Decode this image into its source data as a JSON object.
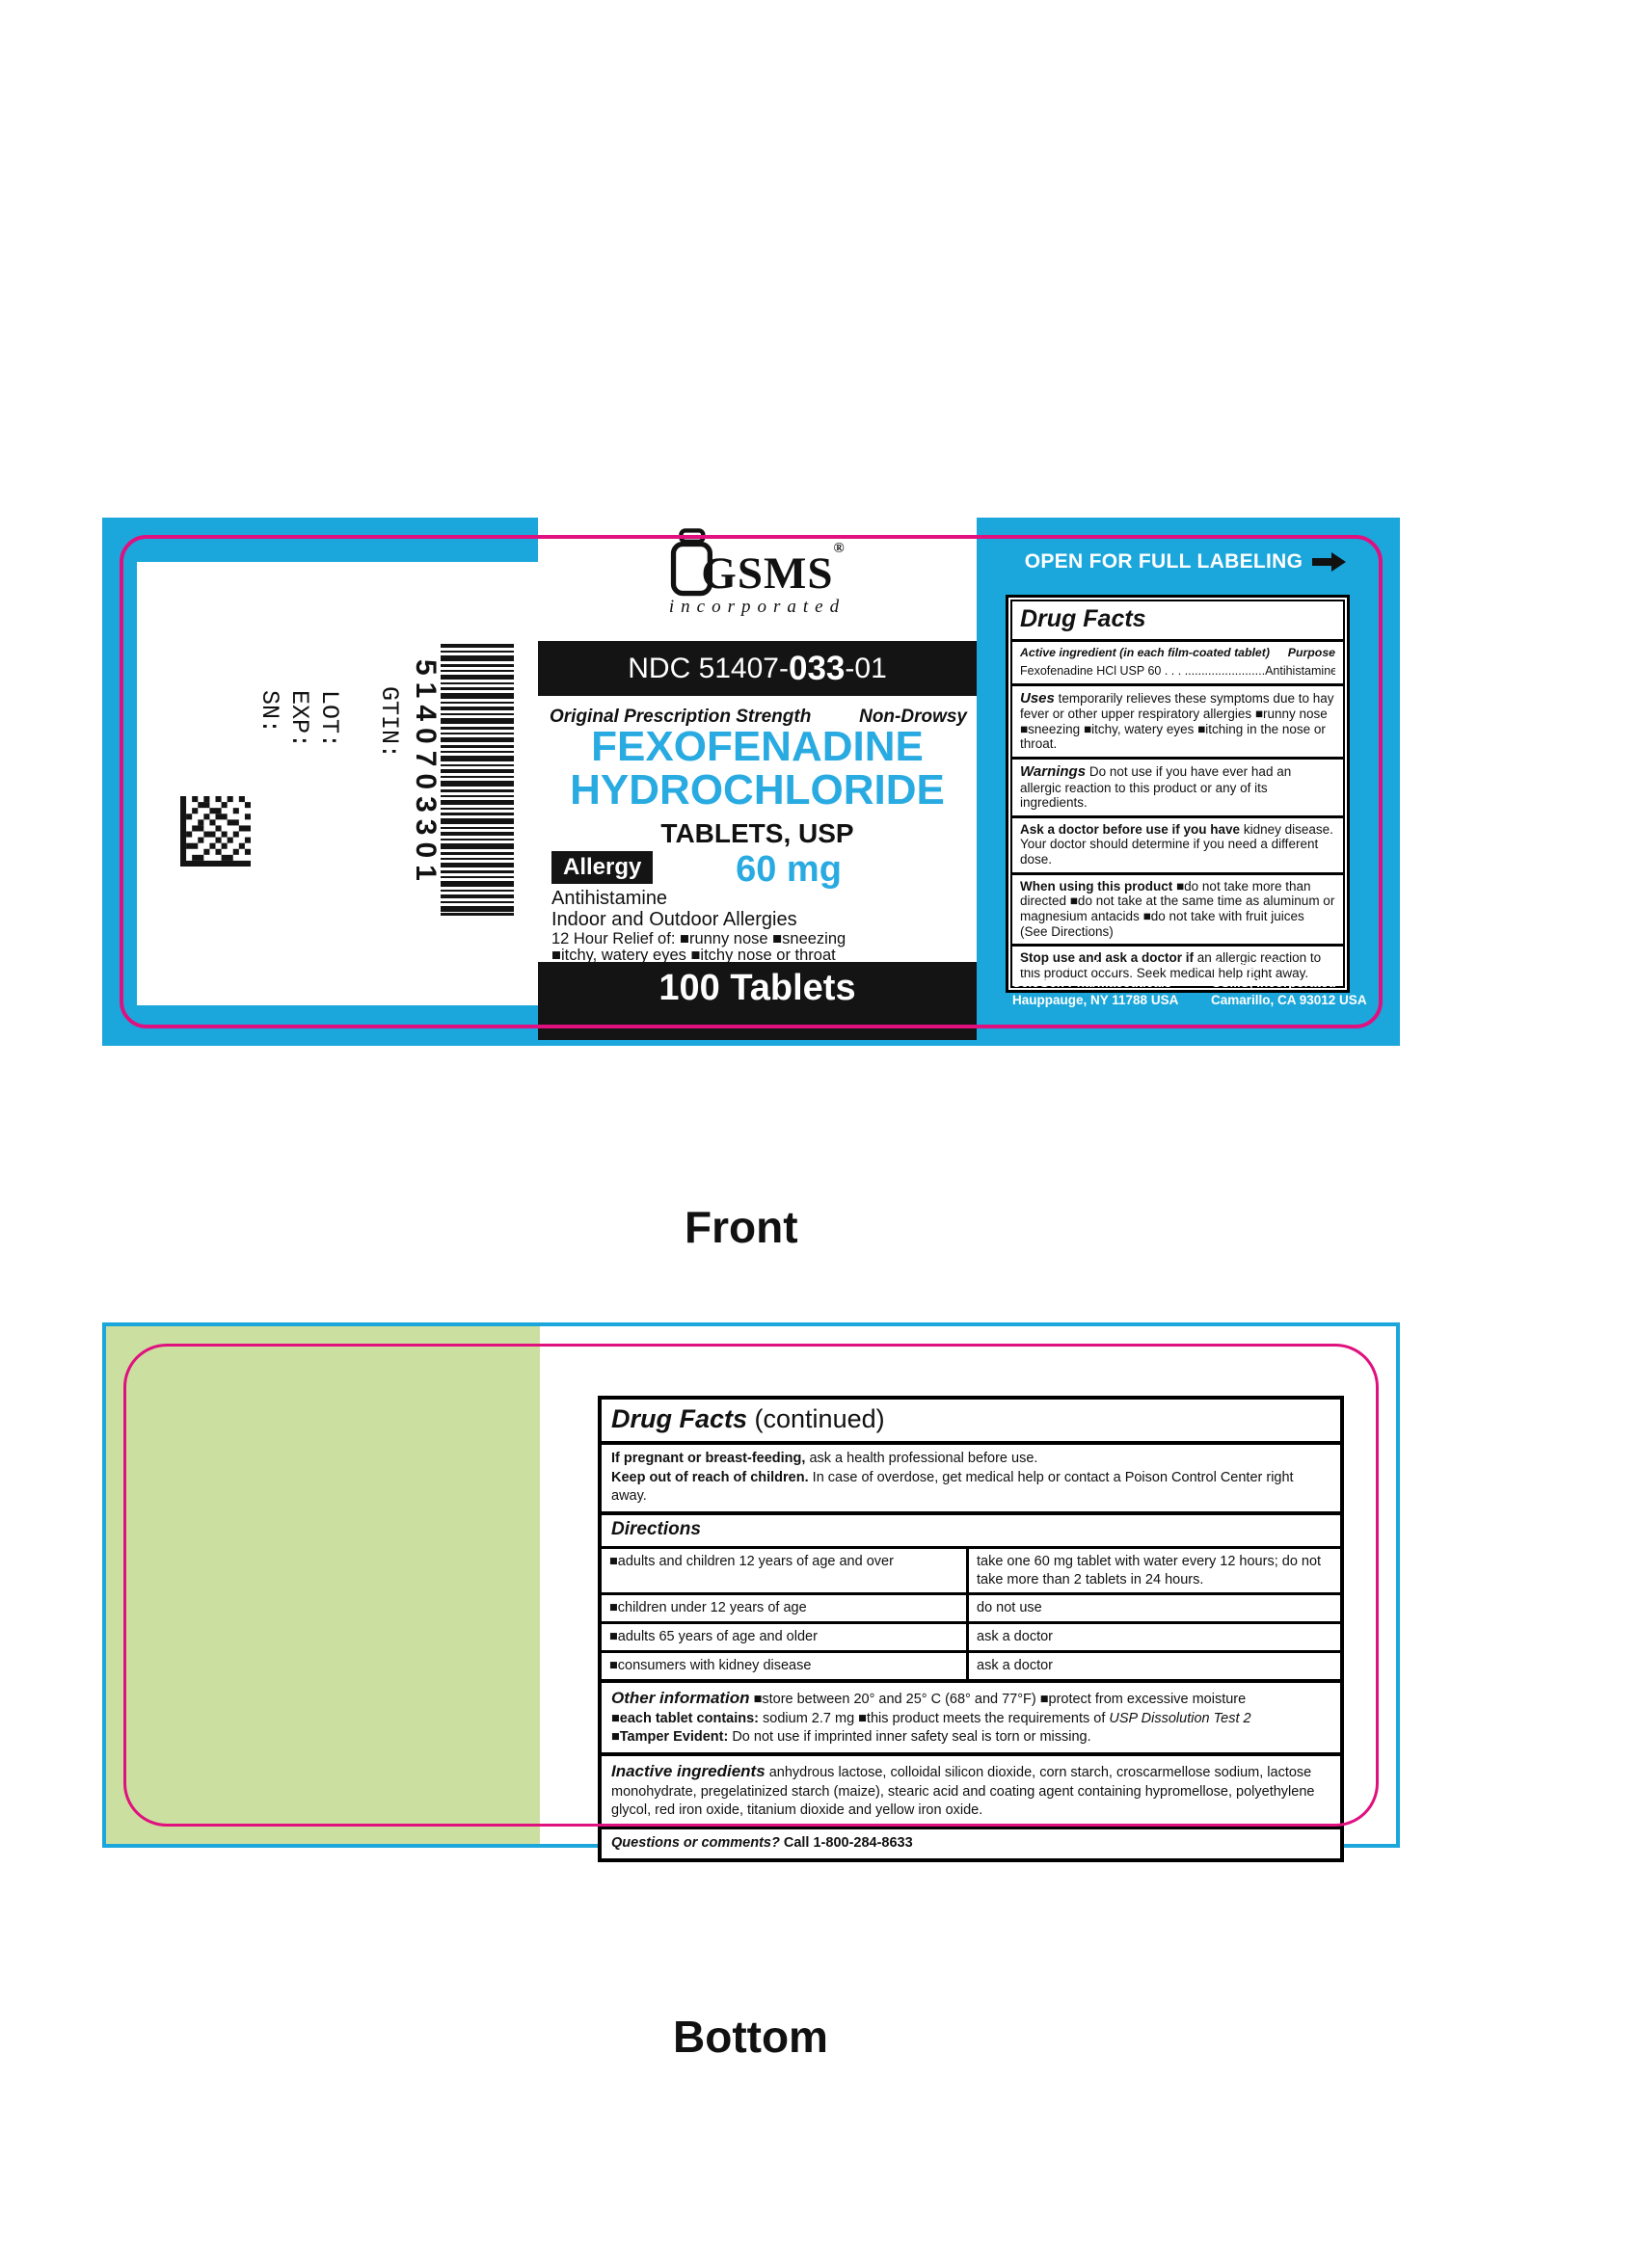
{
  "captions": {
    "front": "Front",
    "bottom": "Bottom"
  },
  "colors": {
    "cyan": "#1BA7DC",
    "magenta": "#E0107F",
    "drug_name_cyan": "#29ABE2",
    "green": "#CBDFA0",
    "bar_black": "#141414"
  },
  "front": {
    "open_label": "OPEN FOR FULL LABELING",
    "logo": {
      "gsms": "GSMS",
      "reg": "®",
      "inc": "incorporated"
    },
    "ndc": {
      "p1": "NDC 51407-",
      "p2": "033",
      "p3": "-01"
    },
    "strength_left": "Original Prescription Strength",
    "strength_right": "Non-Drowsy",
    "name1": "FEXOFENADINE",
    "name2": "HYDROCHLORIDE",
    "form": "TABLETS, USP",
    "allergy": "Allergy",
    "dose": "60 mg",
    "antihistamine": "Antihistamine",
    "indoor": "Indoor and Outdoor Allergies",
    "relief1": "12 Hour Relief of: ■runny nose ■sneezing",
    "relief2": "■itchy, watery eyes ■itchy nose or throat",
    "count": "100 Tablets",
    "serials": {
      "gtin": "GTIN:",
      "lot": "LOT:",
      "exp": "EXP:",
      "sn": "SN:",
      "code": "5140703301"
    },
    "facts": {
      "title": "Drug Facts",
      "active_header": "Active ingredient (in each film-coated tablet)",
      "purpose_header": "Purpose",
      "active_name": "Fexofenadine HCl USP 60",
      "active_dots": " . . . ........................",
      "active_purpose": "Antihistamine",
      "uses_lead": "Uses",
      "uses_text": " temporarily relieves these symptoms due to hay fever or other upper respiratory allergies ■runny nose ■sneezing ■itchy, watery eyes ■itching in the nose or throat.",
      "warn_lead": "Warnings",
      "warn_text": " Do not use if you have ever had an allergic reaction to this product or any of its ingredients.",
      "ask_lead": "Ask a doctor before use if you have",
      "ask_text": " kidney disease. Your doctor should determine if you need a different dose.",
      "when_lead": "When using this product",
      "when_text": " ■do not take more than directed ■do not take at the same time as aluminum or magnesium antacids ■do not take with fruit juices (See Directions)",
      "stop_lead": "Stop use and ask a doctor if",
      "stop_text": " an allergic reaction to this product occurs. Seek medical help right away."
    },
    "mfg": {
      "label": "Manufactured by:",
      "line1": "ScieGen Pharmaceuticals",
      "line2": "Hauppauge, NY 11788 USA"
    },
    "pkg": {
      "label": "Packaged by:",
      "line1": "GSMS, Incorporated",
      "line2": "Camarillo, CA 93012 USA"
    }
  },
  "bottom": {
    "facts": {
      "title": "Drug Facts",
      "continued": " (continued)",
      "preg_lead": "If pregnant or breast-feeding,",
      "preg_text": " ask a health professional before use.",
      "keep_lead": "Keep out of reach of children.",
      "keep_text": " In case of overdose, get medical help or contact a Poison Control Center right away.",
      "directions_title": "Directions",
      "rows": [
        {
          "who": "■adults and children 12 years of age and over",
          "dose": "take one 60 mg tablet with water every 12 hours; do not take more than 2 tablets in 24 hours."
        },
        {
          "who": "■children under 12 years of age",
          "dose": "do not use"
        },
        {
          "who": "■adults 65 years of age and older",
          "dose": "ask a doctor"
        },
        {
          "who": "■consumers with kidney disease",
          "dose": "ask a doctor"
        }
      ],
      "other_lead": "Other information",
      "other_t1": " ■store between 20° and 25° C (68° and 77°F) ■protect from excessive moisture",
      "other_b2": "■each tablet contains:",
      "other_t2": " sodium 2.7 mg ■this product meets the requirements of ",
      "other_i2": "USP Dissolution Test 2",
      "other_b3": "■Tamper Evident:",
      "other_t3": " Do not use if imprinted inner safety seal is torn or missing.",
      "inactive_lead": "Inactive ingredients",
      "inactive_text": " anhydrous lactose, colloidal silicon dioxide, corn starch, croscarmellose sodium, lactose monohydrate, pregelatinized starch (maize), stearic acid and coating agent containing hypromellose, polyethylene glycol, red iron oxide, titanium dioxide and yellow iron oxide.",
      "q_lead": "Questions or comments?",
      "q_text": " Call 1-800-284-8633"
    }
  }
}
